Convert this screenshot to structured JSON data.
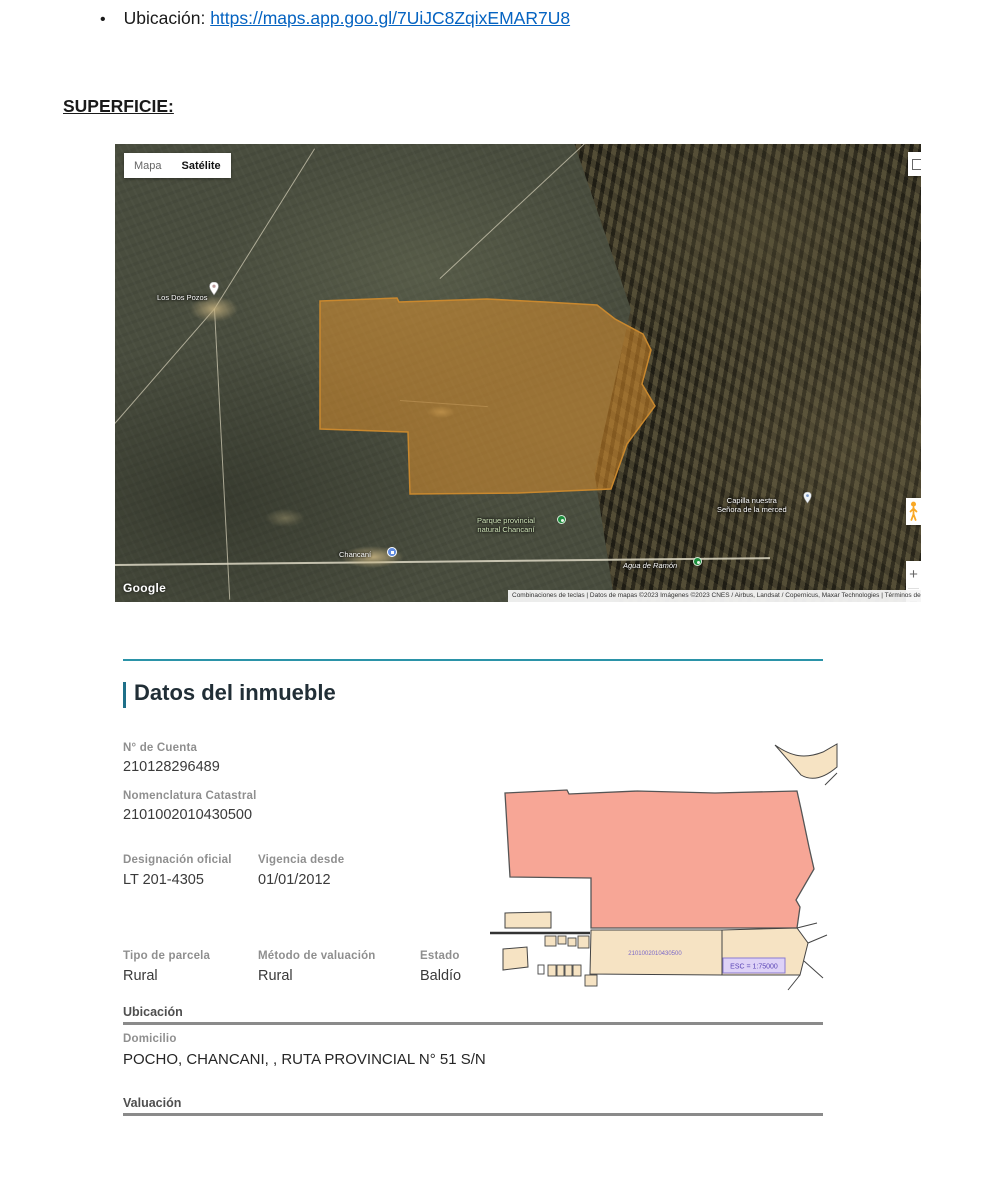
{
  "document": {
    "bullet_glyph": "•",
    "bullet_label": "Ubicación: ",
    "bullet_link": "https://maps.app.goo.gl/7UiJC8ZqixEMAR7U8",
    "superficie_heading": "SUPERFICIE:"
  },
  "map": {
    "type_buttons": {
      "mapa": "Mapa",
      "satelite": "Satélite"
    },
    "labels": {
      "los_dos_pozos": "Los Dos Pozos",
      "parque_l1": "Parque provincial",
      "parque_l2": "natural Chancaní",
      "town": "Chancaní",
      "agua": "Agua de Ramón",
      "capilla_l1": "Capilla nuestra",
      "capilla_l2": "Señora de la merced"
    },
    "google": "Google",
    "attribution": "Combinaciones de teclas | Datos de mapas ©2023 Imágenes ©2023 CNES / Airbus, Landsat / Copernicus, Maxar Technologies | Términos de uso | Notificar un problema de Maps",
    "zoom_in": "+",
    "zoom_out": "−"
  },
  "inmueble": {
    "title": "Datos del inmueble",
    "cuenta_label": "N° de Cuenta",
    "cuenta_value": "210128296489",
    "nomenclatura_label": "Nomenclatura Catastral",
    "nomenclatura_value": "2101002010430500",
    "designacion_label": "Designación oficial",
    "designacion_value": "LT 201-4305",
    "vigencia_label": "Vigencia desde",
    "vigencia_value": "01/01/2012",
    "tipo_label": "Tipo de parcela",
    "tipo_value": "Rural",
    "metodo_label": "Método de valuación",
    "metodo_value": "Rural",
    "estado_label": "Estado",
    "estado_value": "Baldío",
    "ubicacion_header": "Ubicación",
    "domicilio_label": "Domicilio",
    "domicilio_value": "POCHO, CHANCANI, , RUTA PROVINCIAL N° 51 S/N",
    "valuacion_header": "Valuación"
  },
  "diagram": {
    "parcel_number": "2101002010430500",
    "scale": "ESC = 1:75000"
  },
  "colors": {
    "link_blue": "#0563C1",
    "teal": "#2b93a8",
    "parcel_orange": "#e0922f",
    "diagram_pink": "#f7a696",
    "diagram_beige": "#f6e3c3",
    "scale_purple": "#5b45b5"
  }
}
